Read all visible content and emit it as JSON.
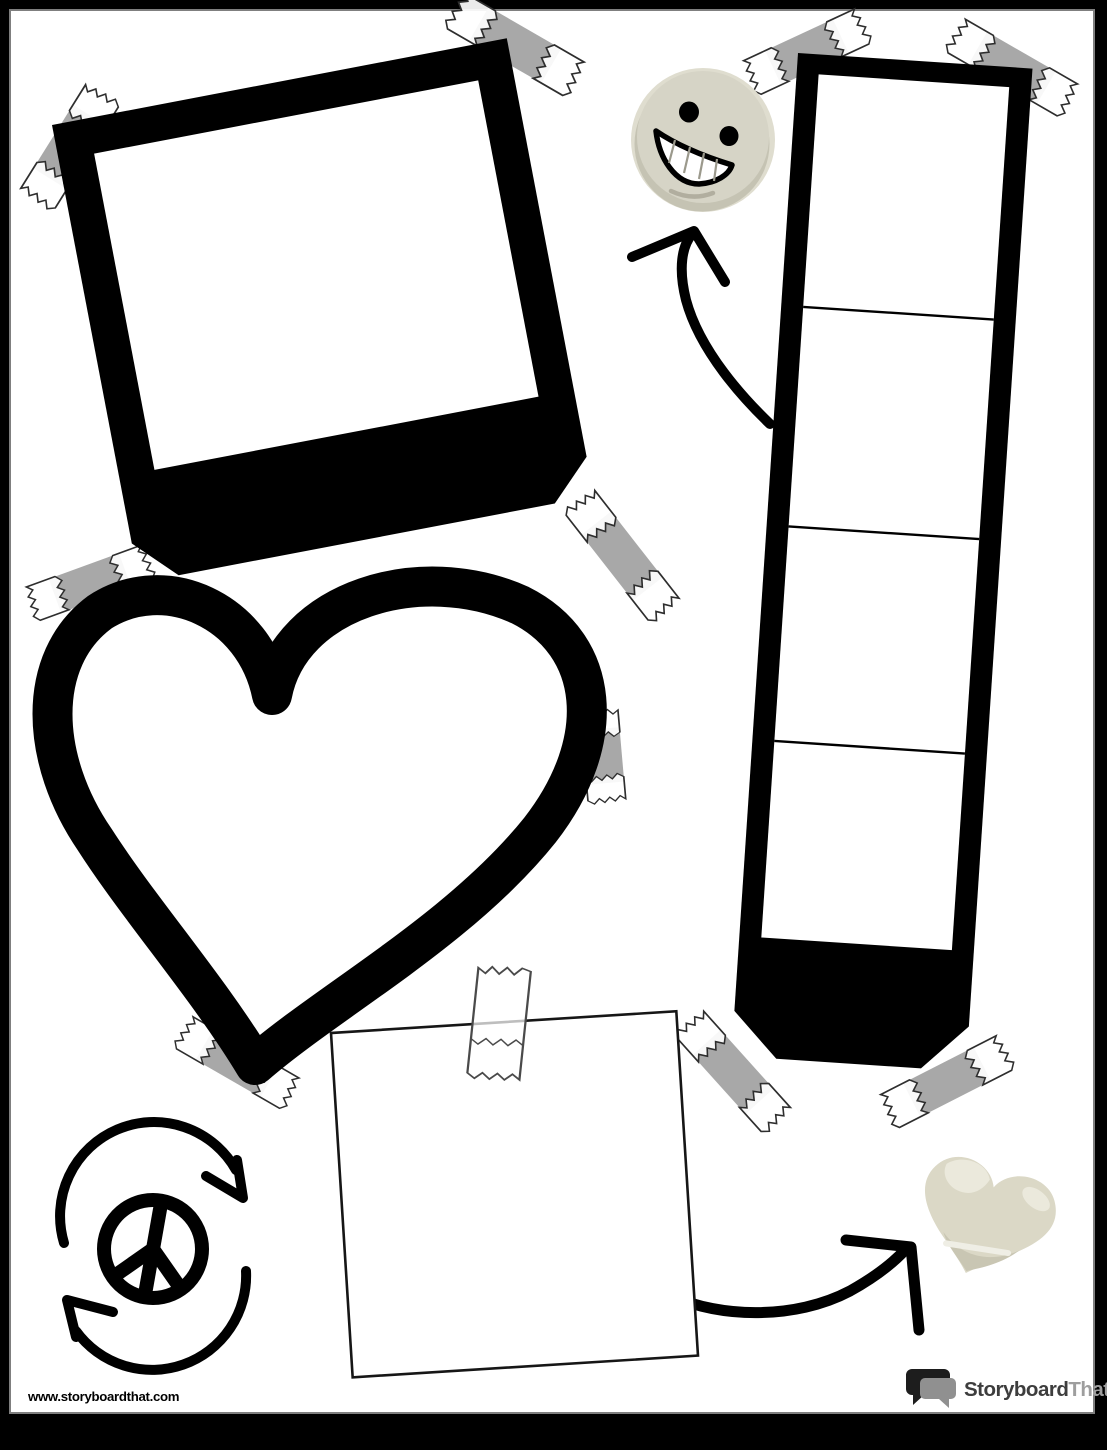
{
  "page": {
    "background_color": "#ffffff",
    "border_color": "#000000",
    "inner_border_color": "#7f7f7f"
  },
  "colors": {
    "ink": "#000000",
    "tape_fill": "#a8a8a8",
    "tape_outline": "#2e2e2e",
    "smiley_base": "#d6d4c6",
    "smiley_light": "#dfddcf",
    "smiley_shadow": "#c3c1b1",
    "heart_sticker_fill": "#dbd8c6",
    "heart_sticker_light": "#ebe9dc",
    "heart_sticker_dark": "#c9c6b3",
    "logo_text_primary": "#3d3d3d",
    "logo_text_secondary": "#9e9e9e",
    "logo_bubble_dark": "#1d1d1d",
    "logo_bubble_grey": "#909090"
  },
  "scrapbook": {
    "polaroid_frame": {
      "taped_corners": 3
    },
    "filmstrip": {
      "panel_count": 4,
      "taped_corners": 4
    },
    "heart_frame": {
      "taped_edges": 3
    },
    "note_square": {
      "taped_edges": 1
    },
    "stickers": [
      "smiley face",
      "peace sign with recycle arrows",
      "beige heart"
    ],
    "arrow_count": 2
  },
  "footer": {
    "watermark": "www.storyboardthat.com",
    "logo_part1": "Storyboard",
    "logo_part2": "That"
  }
}
